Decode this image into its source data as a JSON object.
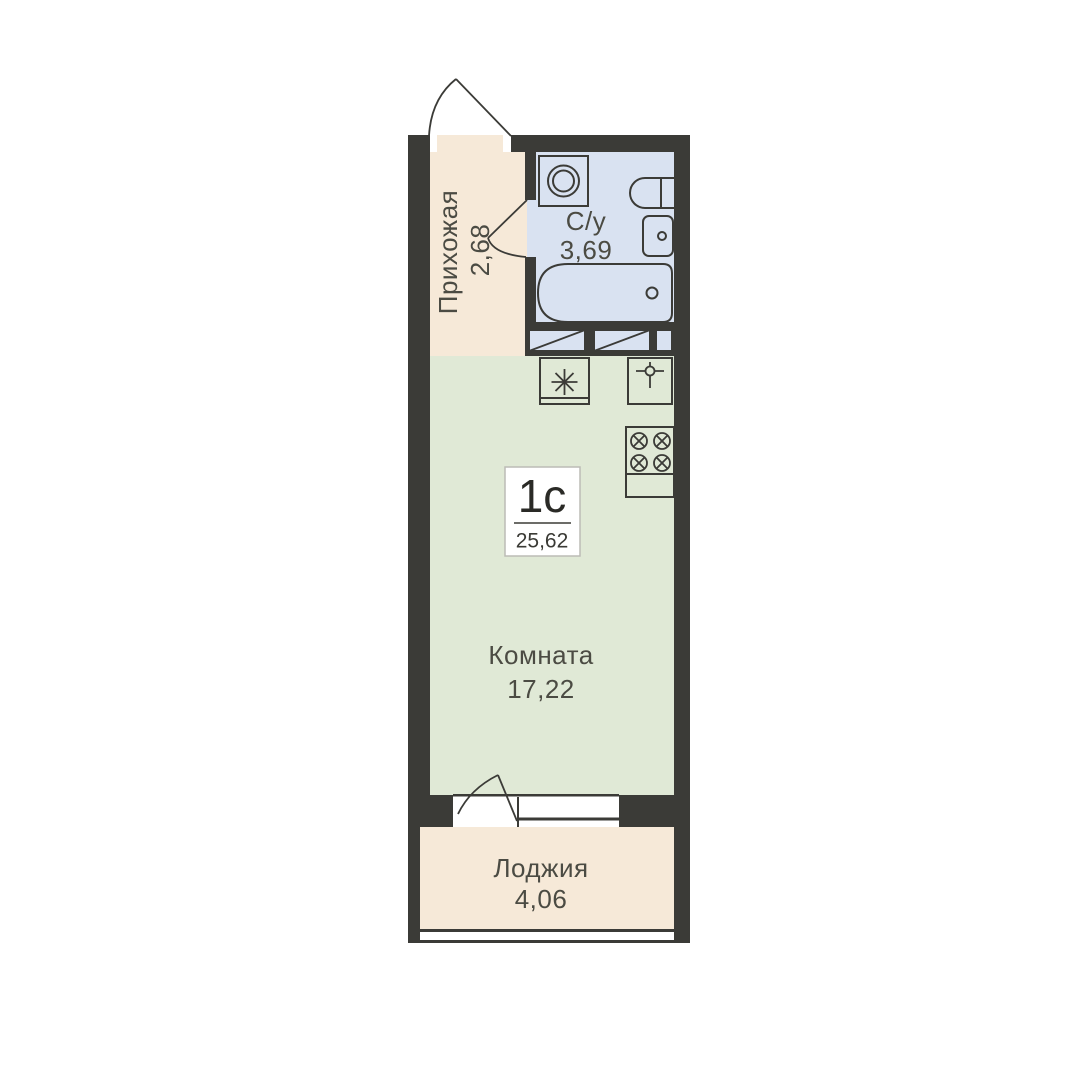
{
  "unit_card": {
    "type_label": "1с",
    "total_area": "25,62"
  },
  "rooms": [
    {
      "name": "Прихожая",
      "area": "2,68"
    },
    {
      "name": "С/у",
      "area": "3,69"
    },
    {
      "name": "Комната",
      "area": "17,22"
    },
    {
      "name": "Лоджия",
      "area": "4,06"
    }
  ],
  "fixtures": [
    "entrance-door-swing",
    "washing-machine",
    "toilet",
    "washbasin",
    "bathtub",
    "ventilation-duct",
    "fridge-snowflake",
    "kitchen-sink-faucet",
    "stove-burners",
    "kitchen-counter",
    "balcony-door-swing",
    "window"
  ],
  "colors": {
    "background": "#ffffff",
    "wall": "#3b3b37",
    "hallway": "#f6e9d8",
    "bathroom": "#d9e2f1",
    "room": "#e0e9d6",
    "balcony": "#f6e9d8",
    "label_text": "#4b4b43",
    "unit_text": "#2a2a26",
    "unit_box_border": "#bcbcb6"
  }
}
